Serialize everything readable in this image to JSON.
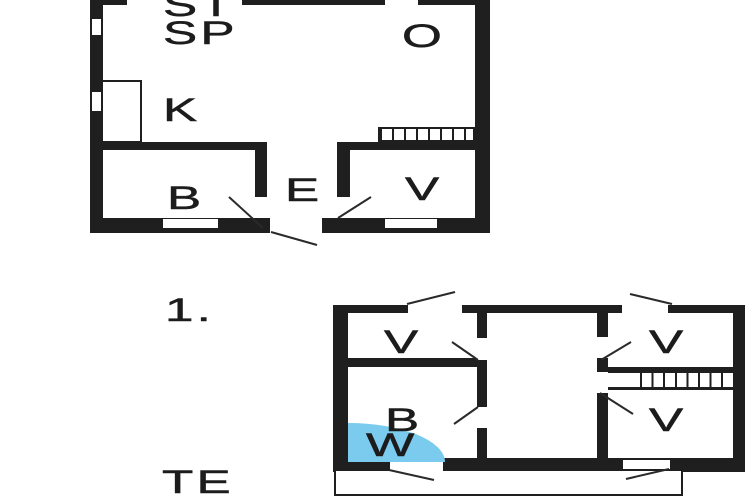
{
  "colors": {
    "wall": "#1f1f1f",
    "line": "#2a2a2a",
    "shower_blue": "#7bcbee",
    "background": "#ffffff",
    "label": "#1c1c1c"
  },
  "ground_floor": {
    "labels": {
      "st": "ST",
      "sp": "SP",
      "o": "O",
      "k": "K",
      "b": "B",
      "e": "E",
      "v": "V"
    }
  },
  "first_floor": {
    "number": "1.",
    "labels": {
      "v_top_left": "V",
      "b": "B",
      "w": "W",
      "v_top_right": "V",
      "v_bottom_right": "V"
    },
    "terrace": "TE"
  }
}
